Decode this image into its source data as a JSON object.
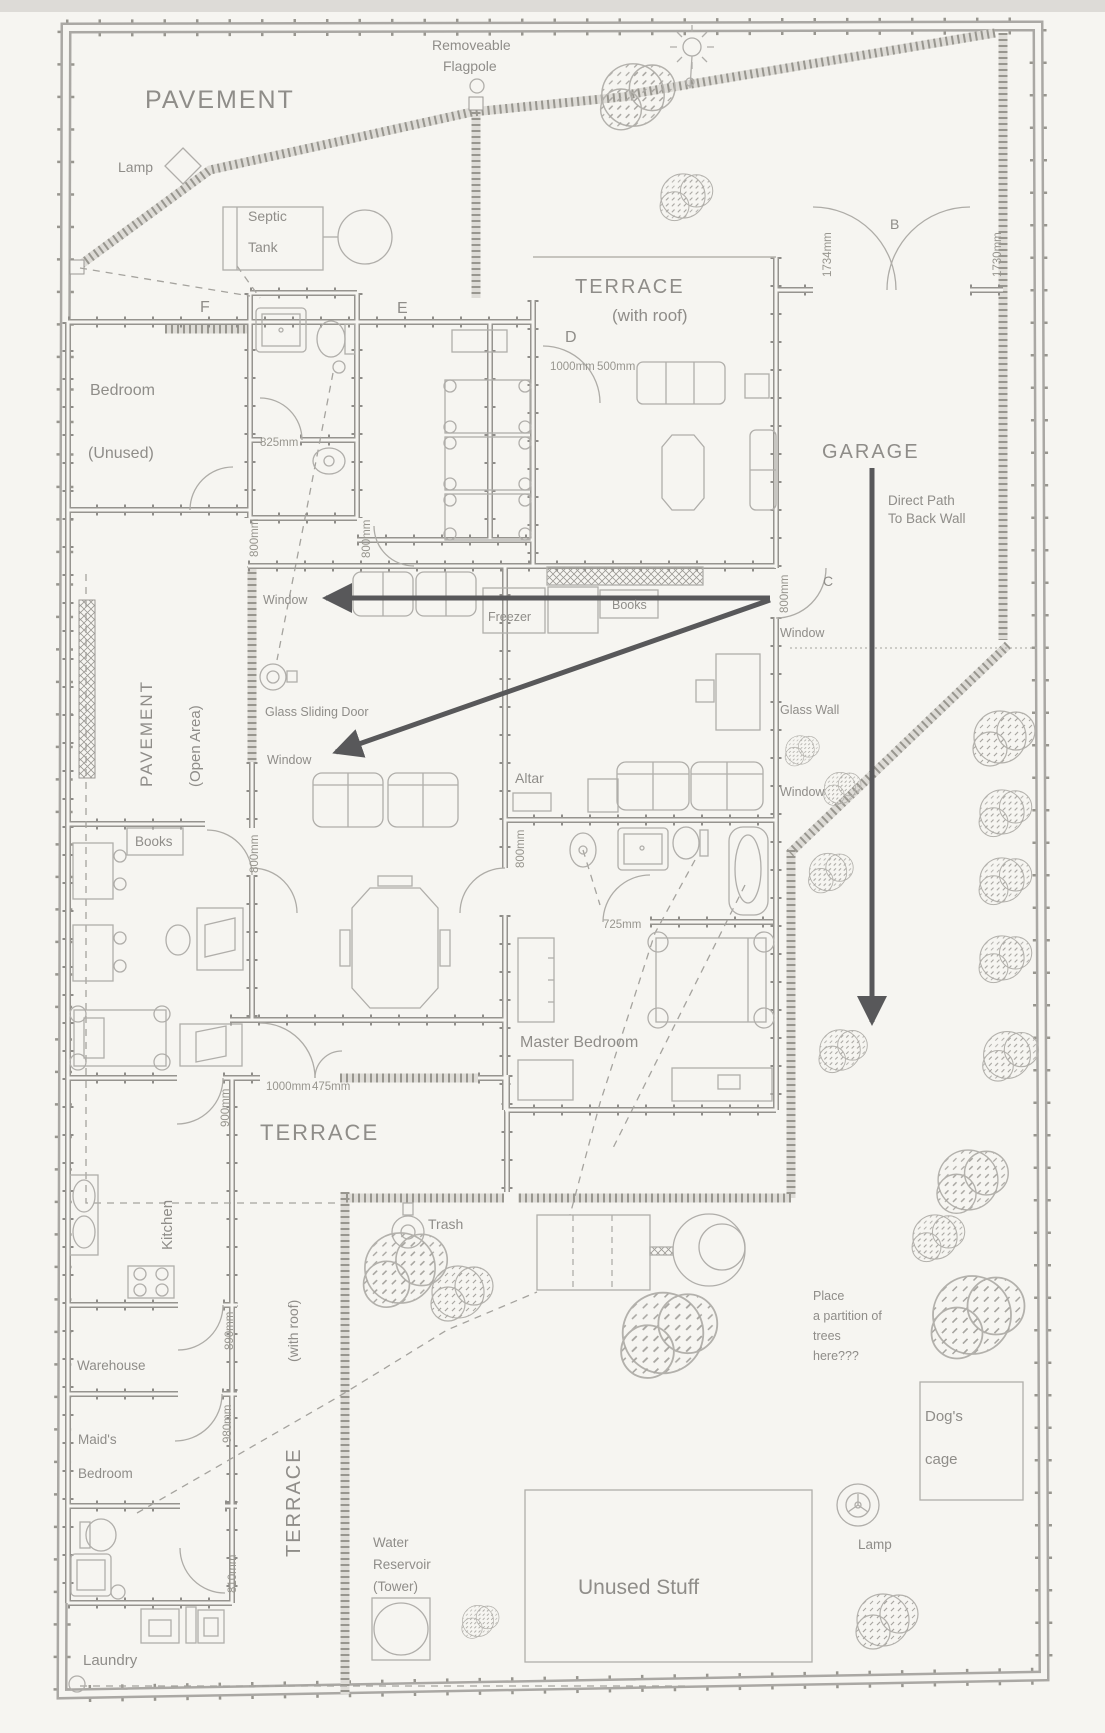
{
  "colors": {
    "paper": "#f6f5f1",
    "ink": "#8f8d89",
    "wall": "#96948f",
    "arrow": "#58585a"
  },
  "areas": {
    "pavement_top": "PAVEMENT",
    "terrace_top": "TERRACE",
    "terrace_top_sub": "(with roof)",
    "garage": "GARAGE",
    "bedroom_unused_l1": "Bedroom",
    "bedroom_unused_l2": "(Unused)",
    "pavement_open_l1": "PAVEMENT",
    "pavement_open_l2": "(Open Area)",
    "master_bedroom": "Master Bedroom",
    "terrace_mid": "TERRACE",
    "kitchen": "Kitchen",
    "terrace_left_sub": "(with roof)",
    "terrace_left": "TERRACE",
    "warehouse": "Warehouse",
    "maids_l1": "Maid's",
    "maids_l2": "Bedroom",
    "laundry": "Laundry"
  },
  "features": {
    "flagpole_l1": "Removeable",
    "flagpole_l2": "Flagpole",
    "lamp_top": "Lamp",
    "septic_l1": "Septic",
    "septic_l2": "Tank",
    "window_1": "Window",
    "window_2": "Window",
    "window_3": "Window",
    "window_4": "Window",
    "freezer": "Freezer",
    "books_shelf": "Books",
    "books_room": "Books",
    "glass_sliding_door": "Glass Sliding Door",
    "glass_wall": "Glass Wall",
    "altar": "Altar",
    "trash": "Trash",
    "water_l1": "Water",
    "water_l2": "Reservoir",
    "water_l3": "(Tower)",
    "unused_stuff": "Unused Stuff",
    "dogs_cage_l1": "Dog's",
    "dogs_cage_l2": "cage",
    "lamp_bottom": "Lamp"
  },
  "doors": {
    "b": "B",
    "c": "C",
    "d": "D",
    "e": "E",
    "f": "F"
  },
  "dimensions": {
    "gate_b_left": "1734mm",
    "gate_b_right": "1730mm",
    "bath_door": "825mm",
    "door_d_width": "1000mm",
    "door_d_side": "500mm",
    "door_c": "800mm",
    "hall_door_left": "800mm",
    "hall_door_right": "800mm",
    "study_door": "800mm",
    "master_door": "800mm",
    "master_bath_door": "725mm",
    "kitchen_door": "900mm",
    "terrace_door_width": "1000mm",
    "terrace_door_side": "475mm",
    "warehouse_door": "890mm",
    "maids_door": "980mm",
    "laundry_door": "810mm"
  },
  "annotations": {
    "direct_path_l1": "Direct Path",
    "direct_path_l2": "To Back Wall",
    "partition_l1": "Place",
    "partition_l2": "a partition of",
    "partition_l3": "trees",
    "partition_l4": "here???"
  }
}
